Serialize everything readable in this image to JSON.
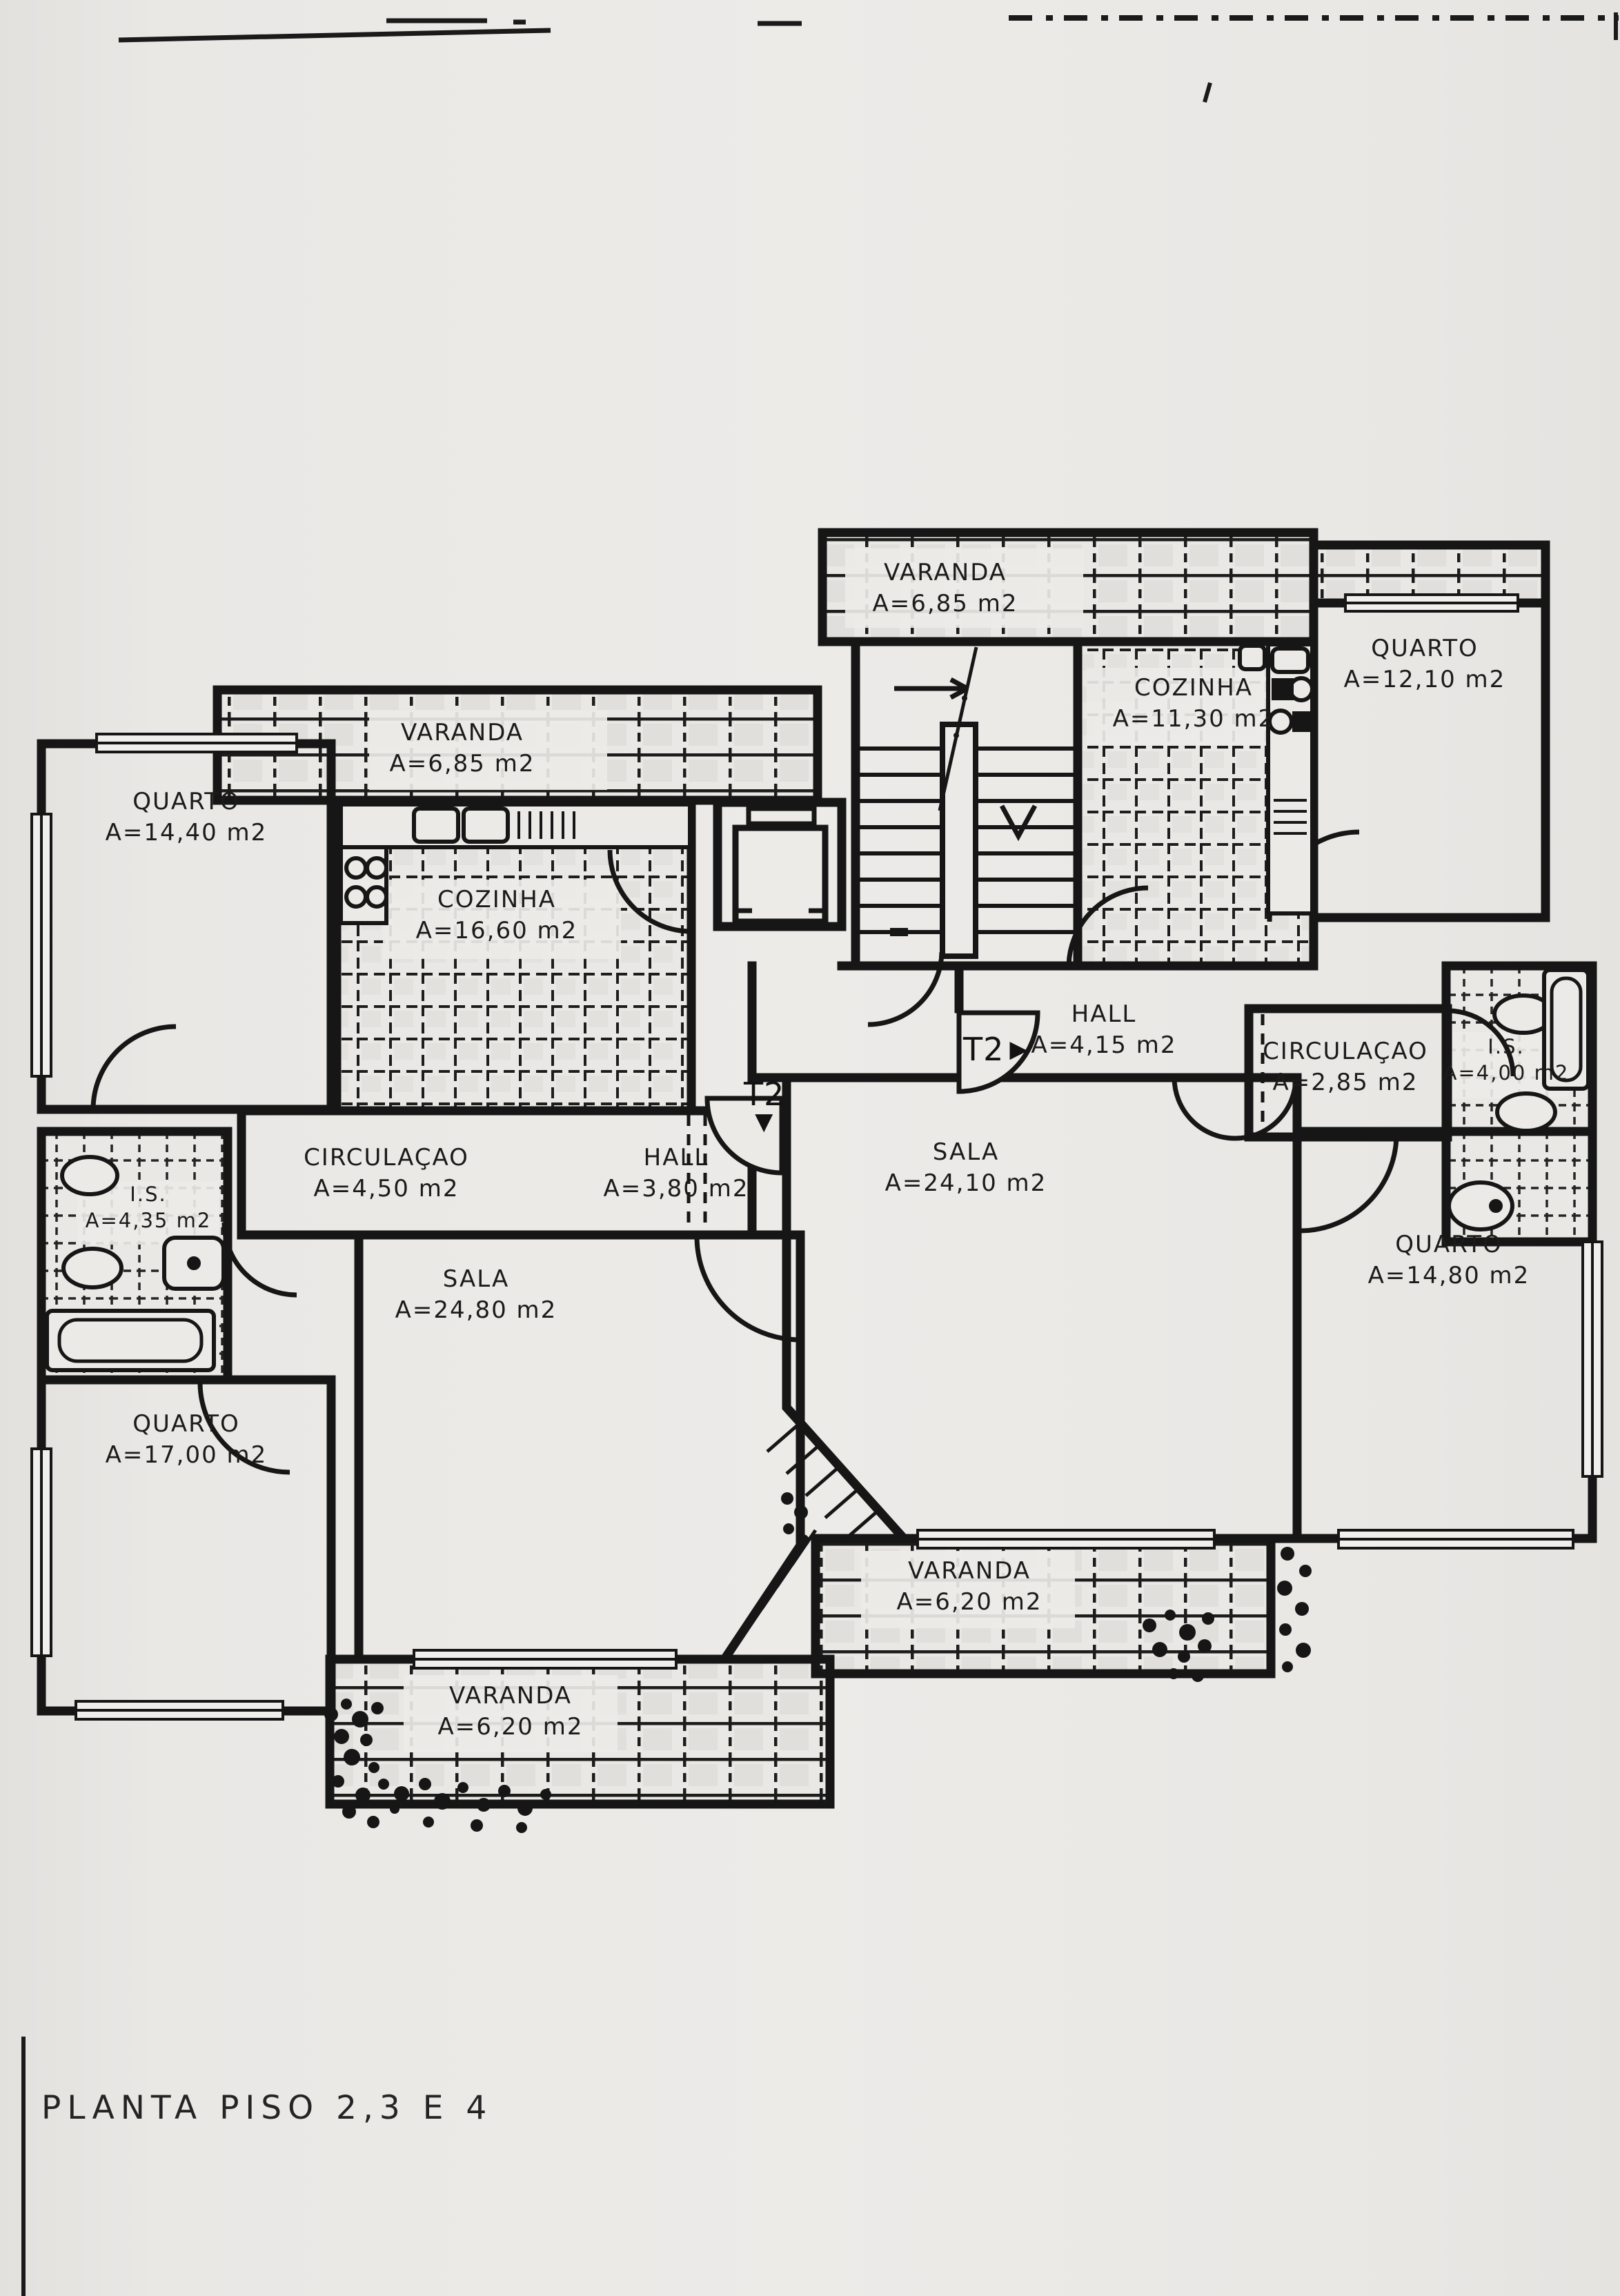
{
  "title": "PLANTA PISO 2,3 E 4",
  "units": {
    "t2_right": {
      "label": "T2",
      "arrow": "▶"
    },
    "t2_down": {
      "label": "T2",
      "arrow": "▼"
    }
  },
  "rooms": {
    "varanda_top": {
      "name": "VARANDA",
      "area": "A=6,85 m2"
    },
    "quarto_top_right": {
      "name": "QUARTO",
      "area": "A=12,10 m2"
    },
    "cozinha_right": {
      "name": "COZINHA",
      "area": "A=11,30 m2"
    },
    "varanda_left": {
      "name": "VARANDA",
      "area": "A=6,85 m2"
    },
    "quarto_top_left": {
      "name": "QUARTO",
      "area": "A=14,40 m2"
    },
    "cozinha_left": {
      "name": "COZINHA",
      "area": "A=16,60 m2"
    },
    "hall_right": {
      "name": "HALL",
      "area": "A=4,15 m2"
    },
    "circulacao_right": {
      "name": "CIRCULAÇAO",
      "area": "A=2,85 m2"
    },
    "is_right": {
      "name": "I.S.",
      "area": "A=4,00 m2"
    },
    "sala_right": {
      "name": "SALA",
      "area": "A=24,10 m2"
    },
    "circulacao_left": {
      "name": "CIRCULAÇAO",
      "area": "A=4,50 m2"
    },
    "hall_left": {
      "name": "HALL",
      "area": "A=3,80 m2"
    },
    "is_left": {
      "name": "I.S.",
      "area": "A=4,35 m2"
    },
    "sala_left": {
      "name": "SALA",
      "area": "A=24,80 m2"
    },
    "quarto_right": {
      "name": "QUARTO",
      "area": "A=14,80 m2"
    },
    "quarto_bottom_left": {
      "name": "QUARTO",
      "area": "A=17,00 m2"
    },
    "varanda_mid": {
      "name": "VARANDA",
      "area": "A=6,20 m2"
    },
    "varanda_bottom": {
      "name": "VARANDA",
      "area": "A=6,20 m2"
    }
  },
  "colors": {
    "paper": "#eceae7",
    "ink": "#161616"
  }
}
